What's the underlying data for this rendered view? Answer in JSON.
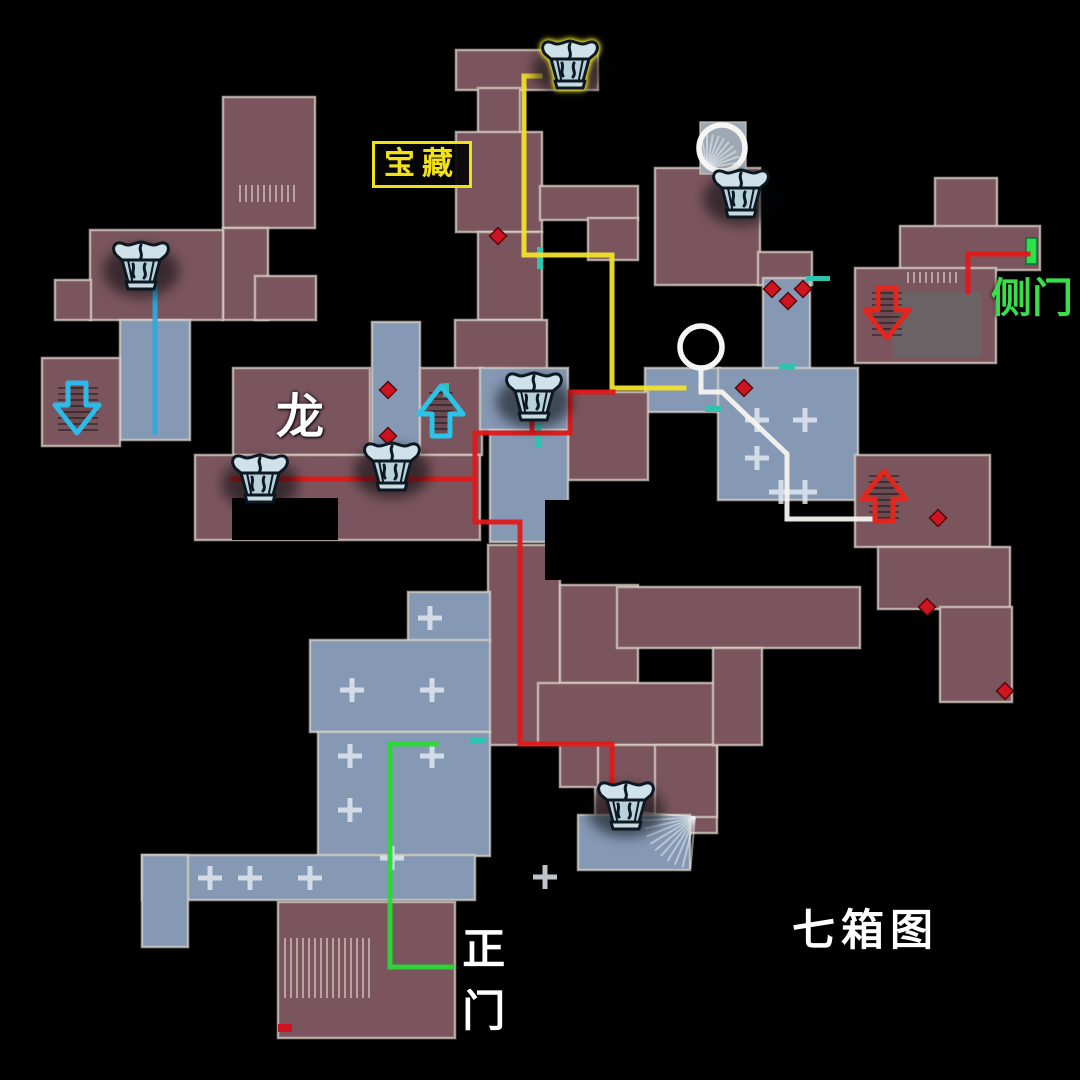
{
  "canvas": {
    "width": 1080,
    "height": 1080,
    "background": "#000000"
  },
  "labels": [
    {
      "name": "treasure-label",
      "text": "宝藏",
      "color": "#f2e117",
      "x": 372,
      "y": 141,
      "size": 31,
      "boxed": true
    },
    {
      "name": "dragon-label",
      "text": "龙",
      "color": "#ffffff",
      "x": 276,
      "y": 392,
      "size": 48,
      "boxed": false
    },
    {
      "name": "side-door-label",
      "text": "侧门",
      "color": "#3ade4b",
      "x": 991,
      "y": 276,
      "size": 41,
      "boxed": false
    },
    {
      "name": "main-gate-label",
      "text": "正门",
      "color": "#ffffff",
      "x": 459,
      "y": 919,
      "size": 43,
      "boxed": false,
      "vertical": true
    },
    {
      "name": "seven-chest-title",
      "text": "七箱图",
      "color": "#ffffff",
      "x": 792,
      "y": 908,
      "size": 43,
      "boxed": false,
      "spacing": 6
    }
  ],
  "map": {
    "colors": {
      "maroon": "#7b555d",
      "blue": "#8598b4",
      "tile": "#9fa9b4",
      "dark_inset": "#6b6266",
      "wall": "rgba(214,206,196,0.75)",
      "black": "#000000",
      "cross": "rgba(224,230,238,0.85)",
      "diamond": "#cf1420",
      "teal_door": "#2fc3ae",
      "green_door": "#2ee04a"
    },
    "rooms": [
      [
        456,
        50,
        142,
        40,
        "m"
      ],
      [
        478,
        88,
        42,
        46,
        "m"
      ],
      [
        456,
        132,
        86,
        100,
        "m"
      ],
      [
        540,
        186,
        98,
        34,
        "m"
      ],
      [
        588,
        218,
        50,
        42,
        "m"
      ],
      [
        478,
        232,
        64,
        88,
        "m"
      ],
      [
        455,
        320,
        92,
        50,
        "m"
      ],
      [
        655,
        168,
        105,
        117,
        "m"
      ],
      [
        758,
        252,
        54,
        33,
        "m"
      ],
      [
        700,
        122,
        46,
        52,
        "t"
      ],
      [
        763,
        278,
        47,
        92,
        "b"
      ],
      [
        935,
        178,
        62,
        50,
        "m"
      ],
      [
        900,
        226,
        140,
        44,
        "m"
      ],
      [
        855,
        268,
        141,
        95,
        "m"
      ],
      [
        645,
        368,
        75,
        44,
        "b"
      ],
      [
        718,
        368,
        140,
        132,
        "b"
      ],
      [
        855,
        455,
        135,
        92,
        "m"
      ],
      [
        878,
        547,
        132,
        62,
        "m"
      ],
      [
        940,
        607,
        72,
        95,
        "m"
      ],
      [
        223,
        97,
        92,
        131,
        "m"
      ],
      [
        223,
        228,
        45,
        92,
        "m"
      ],
      [
        255,
        276,
        61,
        44,
        "m"
      ],
      [
        90,
        230,
        133,
        90,
        "m"
      ],
      [
        55,
        280,
        36,
        40,
        "m"
      ],
      [
        120,
        320,
        70,
        120,
        "b"
      ],
      [
        42,
        358,
        78,
        88,
        "m"
      ],
      [
        233,
        368,
        137,
        87,
        "m"
      ],
      [
        372,
        322,
        48,
        133,
        "b"
      ],
      [
        420,
        368,
        62,
        87,
        "m"
      ],
      [
        480,
        368,
        88,
        62,
        "b"
      ],
      [
        568,
        392,
        80,
        88,
        "m"
      ],
      [
        195,
        455,
        285,
        85,
        "m"
      ],
      [
        490,
        430,
        78,
        112,
        "b"
      ],
      [
        488,
        545,
        72,
        200,
        "m"
      ],
      [
        560,
        585,
        78,
        98,
        "m"
      ],
      [
        538,
        683,
        178,
        62,
        "m"
      ],
      [
        595,
        745,
        122,
        88,
        "m"
      ],
      [
        655,
        745,
        62,
        72,
        "m"
      ],
      [
        578,
        815,
        112,
        55,
        "b"
      ],
      [
        617,
        587,
        243,
        61,
        "m"
      ],
      [
        713,
        648,
        49,
        97,
        "m"
      ],
      [
        408,
        592,
        82,
        50,
        "b"
      ],
      [
        310,
        640,
        180,
        92,
        "b"
      ],
      [
        318,
        732,
        172,
        124,
        "b"
      ],
      [
        142,
        855,
        333,
        45,
        "b"
      ],
      [
        142,
        855,
        46,
        92,
        "b"
      ],
      [
        278,
        902,
        177,
        136,
        "m"
      ],
      [
        560,
        745,
        38,
        42,
        "m"
      ]
    ],
    "dark_insets": [
      [
        893,
        292,
        88,
        66
      ]
    ],
    "black_insets": [
      [
        232,
        498,
        106,
        42
      ],
      [
        545,
        500,
        44,
        80
      ]
    ],
    "hatches": [
      {
        "x": 58,
        "y": 388,
        "w": 40,
        "h": 44,
        "dir": "h",
        "tone": "dark"
      },
      {
        "x": 872,
        "y": 293,
        "w": 30,
        "h": 46,
        "dir": "h",
        "tone": "dark"
      },
      {
        "x": 869,
        "y": 476,
        "w": 30,
        "h": 44,
        "dir": "h",
        "tone": "dark"
      },
      {
        "x": 429,
        "y": 393,
        "w": 24,
        "h": 46,
        "dir": "h",
        "tone": "dark"
      },
      {
        "x": 240,
        "y": 185,
        "w": 56,
        "h": 17,
        "dir": "v",
        "tone": "light"
      },
      {
        "x": 285,
        "y": 938,
        "w": 88,
        "h": 60,
        "dir": "v",
        "tone": "light"
      },
      {
        "x": 908,
        "y": 272,
        "w": 52,
        "h": 11,
        "dir": "v",
        "tone": "light"
      }
    ],
    "fans": [
      {
        "cx": 707,
        "cy": 168,
        "r": 34,
        "a1": -100,
        "a2": -10,
        "n": 9
      },
      {
        "cx": 695,
        "cy": 817,
        "r": 52,
        "a1": 95,
        "a2": 185,
        "n": 10
      }
    ],
    "crosses": [
      [
        350,
        756
      ],
      [
        432,
        756
      ],
      [
        350,
        810
      ],
      [
        392,
        858
      ],
      [
        250,
        878
      ],
      [
        310,
        878
      ],
      [
        352,
        690
      ],
      [
        432,
        690
      ],
      [
        430,
        618
      ],
      [
        757,
        420
      ],
      [
        805,
        420
      ],
      [
        757,
        458
      ],
      [
        781,
        492
      ],
      [
        805,
        492
      ],
      [
        545,
        877
      ],
      [
        210,
        878
      ]
    ],
    "teal_doors": [
      [
        537,
        247,
        6,
        22
      ],
      [
        535,
        424,
        6,
        24
      ],
      [
        779,
        364,
        16,
        6
      ],
      [
        705,
        406,
        16,
        6
      ],
      [
        443,
        383,
        6,
        14
      ],
      [
        470,
        738,
        16,
        6
      ],
      [
        806,
        276,
        24,
        5
      ]
    ],
    "green_door": {
      "x": 1026,
      "y": 238,
      "w": 11,
      "h": 26
    },
    "diamonds": [
      [
        498,
        236
      ],
      [
        388,
        390
      ],
      [
        388,
        436
      ],
      [
        772,
        289
      ],
      [
        803,
        289
      ],
      [
        788,
        301
      ],
      [
        744,
        388
      ],
      [
        938,
        518
      ],
      [
        927,
        607
      ],
      [
        1005,
        691
      ]
    ],
    "red_spot": [
      278,
      1024,
      14,
      8
    ],
    "circles": [
      {
        "cx": 722,
        "cy": 148,
        "r": 23
      },
      {
        "cx": 701,
        "cy": 347,
        "r": 21
      }
    ]
  },
  "routes": [
    {
      "name": "treasure-yellow-route",
      "color": "#f2e12c",
      "width": 5,
      "points": [
        [
          540,
          76
        ],
        [
          524,
          76
        ],
        [
          524,
          255
        ],
        [
          612,
          255
        ],
        [
          612,
          388
        ],
        [
          684,
          388
        ]
      ]
    },
    {
      "name": "white-lower-route",
      "color": "#f4f3ef",
      "width": 5,
      "points": [
        [
          701,
          368
        ],
        [
          701,
          392
        ],
        [
          722,
          392
        ],
        [
          787,
          454
        ],
        [
          787,
          519
        ],
        [
          875,
          519
        ],
        [
          875,
          512
        ]
      ]
    },
    {
      "name": "red-main-route",
      "color": "#e01818",
      "width": 5,
      "points": [
        [
          613,
          392
        ],
        [
          570,
          392
        ],
        [
          570,
          433
        ],
        [
          475,
          433
        ],
        [
          475,
          522
        ],
        [
          520,
          522
        ],
        [
          520,
          744
        ],
        [
          612,
          744
        ],
        [
          612,
          786
        ]
      ]
    },
    {
      "name": "red-chest-row-route",
      "color": "#e01818",
      "width": 5,
      "points": [
        [
          233,
          479
        ],
        [
          475,
          479
        ]
      ]
    },
    {
      "name": "red-chest-link-route",
      "color": "#e01818",
      "width": 5,
      "points": [
        [
          532,
          433
        ],
        [
          532,
          416
        ]
      ]
    },
    {
      "name": "red-side-door-route",
      "color": "#e01818",
      "width": 5,
      "points": [
        [
          1028,
          254
        ],
        [
          968,
          254
        ],
        [
          968,
          292
        ]
      ]
    },
    {
      "name": "blue-chest-route",
      "color": "#2da9e0",
      "width": 5,
      "points": [
        [
          155,
          284
        ],
        [
          155,
          432
        ]
      ]
    },
    {
      "name": "green-main-gate-route",
      "color": "#2bd838",
      "width": 5,
      "points": [
        [
          436,
          744
        ],
        [
          390,
          744
        ],
        [
          390,
          967
        ],
        [
          452,
          967
        ]
      ]
    }
  ],
  "chests": [
    {
      "name": "treasure-chest-highlighted",
      "cx": 570,
      "cy": 64,
      "highlight": true
    },
    {
      "name": "treasure-chest-2",
      "cx": 741,
      "cy": 193,
      "highlight": false
    },
    {
      "name": "treasure-chest-3",
      "cx": 141,
      "cy": 265,
      "highlight": false
    },
    {
      "name": "treasure-chest-4",
      "cx": 260,
      "cy": 478,
      "highlight": false
    },
    {
      "name": "treasure-chest-5",
      "cx": 392,
      "cy": 466,
      "highlight": false
    },
    {
      "name": "treasure-chest-6",
      "cx": 534,
      "cy": 396,
      "highlight": false
    },
    {
      "name": "treasure-chest-7",
      "cx": 626,
      "cy": 805,
      "highlight": false
    }
  ],
  "arrows": [
    {
      "name": "stairs-down-arrow-blue",
      "dir": "down",
      "color": "#2fb9e9",
      "cx": 77,
      "cy": 407
    },
    {
      "name": "stairs-up-arrow-cyan",
      "dir": "up",
      "color": "#2cc3e8",
      "cx": 441,
      "cy": 412
    },
    {
      "name": "stairs-down-arrow-red",
      "dir": "down",
      "color": "#e2261d",
      "cx": 887,
      "cy": 312
    },
    {
      "name": "stairs-up-arrow-red",
      "dir": "up",
      "color": "#e2261d",
      "cx": 884,
      "cy": 497
    }
  ]
}
